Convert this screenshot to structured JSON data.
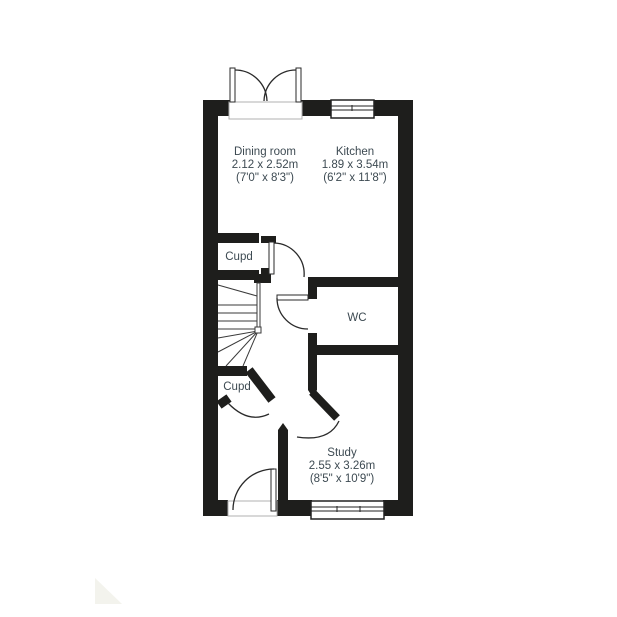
{
  "plan": {
    "rooms": [
      {
        "name": "Dining room",
        "size_m": "2.12 x 2.52m",
        "size_ft": "(7'0\" x 8'3\")"
      },
      {
        "name": "Kitchen",
        "size_m": "1.89 x 3.54m",
        "size_ft": "(6'2\" x 11'8\")"
      },
      {
        "name": "Study",
        "size_m": "2.55 x 3.26m",
        "size_ft": "(8'5\" x 10'9\")"
      },
      {
        "name": "WC"
      },
      {
        "name": "Cupd"
      },
      {
        "name": "Cupd"
      }
    ],
    "colors": {
      "wall": "#1e1e1c",
      "label_text": "#3d4a52",
      "background": "#ffffff",
      "watermark": "#f3f3ed"
    }
  }
}
